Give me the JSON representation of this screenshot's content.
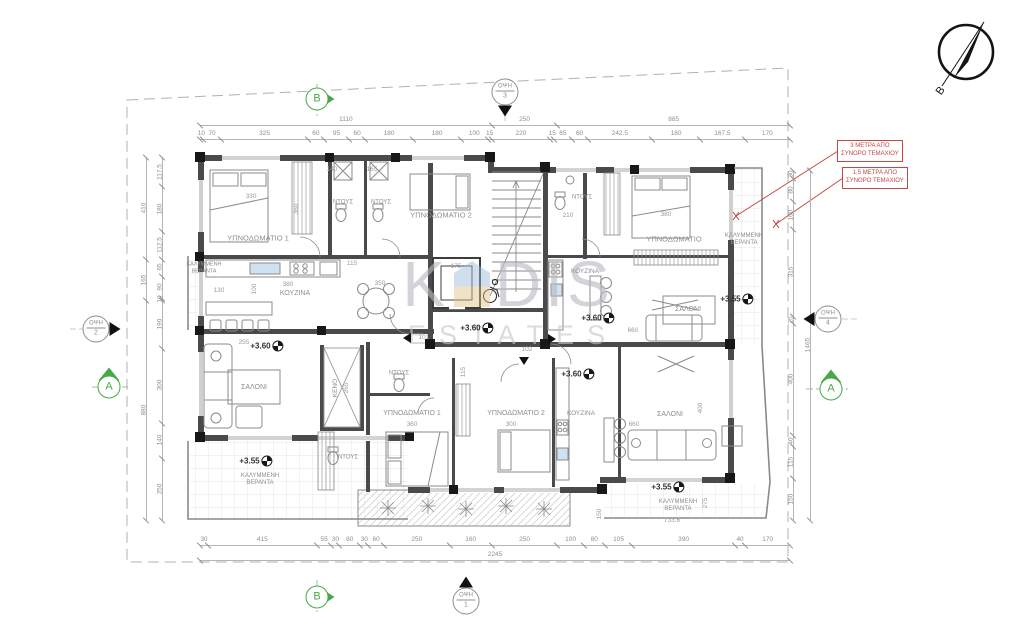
{
  "watermark": {
    "prefix": "K",
    "suffix": "DIS",
    "sub": "ESTATES"
  },
  "compass": {
    "north_letter": "B"
  },
  "red_notes": [
    {
      "line1": "3 ΜΕΤΡΑ ΑΠΟ",
      "line2": "ΣΥΝΟΡΟ ΤΕΜΑΧΙΟΥ",
      "x": 837,
      "y": 140
    },
    {
      "line1": "1,5 ΜΕΤΡΑ ΑΠΟ",
      "line2": "ΣΥΝΟΡΟ ΤΕΜΑΧΙΟΥ",
      "x": 842,
      "y": 167
    }
  ],
  "section_markers": [
    {
      "letter": "B",
      "x": 317,
      "y": 99,
      "dir": "right"
    },
    {
      "letter": "B",
      "x": 317,
      "y": 597,
      "dir": "right"
    },
    {
      "letter": "A",
      "x": 109,
      "y": 387,
      "dir": "up"
    },
    {
      "letter": "A",
      "x": 831,
      "y": 389,
      "dir": "up"
    }
  ],
  "view_markers": [
    {
      "label": "ΟΨΗ",
      "num": "1",
      "x": 466,
      "y": 601,
      "dir": "up"
    },
    {
      "label": "ΟΨΗ",
      "num": "2",
      "x": 96,
      "y": 329,
      "dir": "right"
    },
    {
      "label": "ΟΨΗ",
      "num": "3",
      "x": 505,
      "y": 92,
      "dir": "down"
    },
    {
      "label": "ΟΨΗ",
      "num": "4",
      "x": 828,
      "y": 319,
      "dir": "left"
    }
  ],
  "room_labels": [
    {
      "t": "ΥΠΝΟΔΩΜΑΤΙΟ 1",
      "x": 258,
      "y": 238,
      "s": 7.5
    },
    {
      "t": "ΝΤΟΥΣ",
      "x": 343,
      "y": 203,
      "s": 6
    },
    {
      "t": "ΝΤΟΥΣ",
      "x": 381,
      "y": 203,
      "s": 6
    },
    {
      "t": "ΥΠΝΟΔΩΜΑΤΙΟ 2",
      "x": 441,
      "y": 215,
      "s": 7.5
    },
    {
      "t": "ΚΟΥΖΙΝΑ",
      "x": 295,
      "y": 294,
      "s": 7
    },
    {
      "t": "ΚΑΛΥΜΜΕΝΗ\nΒΕΡΑΝΤΑ",
      "x": 204,
      "y": 268,
      "s": 5.5
    },
    {
      "t": "ΝΤΟΥΣ",
      "x": 582,
      "y": 198,
      "s": 6
    },
    {
      "t": "ΥΠΝΟΔΩΜΑΤΙΟ",
      "x": 674,
      "y": 239,
      "s": 7.5
    },
    {
      "t": "ΚΑΛΥΜΜΕΝΗ\nΒΕΡΑΝΤΑ",
      "x": 744,
      "y": 240,
      "s": 6
    },
    {
      "t": "ΚΟΥΖΙΝΑ",
      "x": 585,
      "y": 272,
      "s": 6.5
    },
    {
      "t": "ΣΑΛΟΝΙ",
      "x": 688,
      "y": 310,
      "s": 7
    },
    {
      "t": "ΣΑΛΟΝΙ",
      "x": 254,
      "y": 388,
      "s": 7
    },
    {
      "t": "ΚΕΝΟ",
      "x": 336,
      "y": 388,
      "s": 6.5,
      "r": 1
    },
    {
      "t": "ΝΤΟΥΣ",
      "x": 399,
      "y": 374,
      "s": 6
    },
    {
      "t": "ΥΠΝΟΔΩΜΑΤΙΟ 1",
      "x": 412,
      "y": 414,
      "s": 7
    },
    {
      "t": "ΝΤΟΥΣ",
      "x": 348,
      "y": 458,
      "s": 6
    },
    {
      "t": "ΚΑΛΥΜΜΕΝΗ\nΒΕΡΑΝΤΑ",
      "x": 260,
      "y": 480,
      "s": 6
    },
    {
      "t": "ΥΠΝΟΔΩΜΑΤΙΟ 2",
      "x": 516,
      "y": 414,
      "s": 7
    },
    {
      "t": "ΚΟΥΖΙΝΑ",
      "x": 581,
      "y": 414,
      "s": 6.5
    },
    {
      "t": "ΣΑΛΟΝΙ",
      "x": 670,
      "y": 415,
      "s": 7
    },
    {
      "t": "ΚΑΛΥΜΜΕΝΗ\nΒΕΡΑΝΤΑ",
      "x": 678,
      "y": 506,
      "s": 6
    }
  ],
  "dim_labels": [
    {
      "t": "330",
      "x": 251,
      "y": 197
    },
    {
      "t": "140",
      "x": 332,
      "y": 170
    },
    {
      "t": "165",
      "x": 372,
      "y": 170
    },
    {
      "t": "360",
      "x": 297,
      "y": 209,
      "r": 1
    },
    {
      "t": "380",
      "x": 666,
      "y": 215
    },
    {
      "t": "350",
      "x": 380,
      "y": 284
    },
    {
      "t": "380",
      "x": 288,
      "y": 285
    },
    {
      "t": "130",
      "x": 219,
      "y": 291
    },
    {
      "t": "100",
      "x": 255,
      "y": 289,
      "r": 1
    },
    {
      "t": "115",
      "x": 352,
      "y": 264
    },
    {
      "t": "175",
      "x": 456,
      "y": 267
    },
    {
      "t": "210",
      "x": 568,
      "y": 216
    },
    {
      "t": "660",
      "x": 633,
      "y": 331
    },
    {
      "t": "360",
      "x": 412,
      "y": 425
    },
    {
      "t": "300",
      "x": 511,
      "y": 425
    },
    {
      "t": "660",
      "x": 634,
      "y": 425
    },
    {
      "t": "400",
      "x": 701,
      "y": 408,
      "r": 1
    },
    {
      "t": "733.6",
      "x": 672,
      "y": 521
    },
    {
      "t": "275",
      "x": 706,
      "y": 503,
      "r": 1
    },
    {
      "t": "150",
      "x": 600,
      "y": 514,
      "r": 1
    },
    {
      "t": "265",
      "x": 347,
      "y": 388,
      "r": 1
    },
    {
      "t": "115",
      "x": 464,
      "y": 372,
      "r": 1
    },
    {
      "t": "101",
      "x": 424,
      "y": 338
    },
    {
      "t": "102",
      "x": 527,
      "y": 350
    },
    {
      "t": "255",
      "x": 244,
      "y": 343
    }
  ],
  "elevation_labels": [
    {
      "t": "+3.60",
      "x": 267,
      "y": 346
    },
    {
      "t": "+3.60",
      "x": 477,
      "y": 328
    },
    {
      "t": "+3.60",
      "x": 598,
      "y": 318
    },
    {
      "t": "+3.60",
      "x": 578,
      "y": 374
    },
    {
      "t": "+3.55",
      "x": 737,
      "y": 299
    },
    {
      "t": "+3.55",
      "x": 256,
      "y": 461
    },
    {
      "t": "+3.55",
      "x": 668,
      "y": 487
    }
  ],
  "entry_arrows": [
    {
      "x": 407,
      "y": 338,
      "dir": "left"
    },
    {
      "x": 552,
      "y": 339,
      "dir": "right"
    },
    {
      "x": 524,
      "y": 361,
      "dir": "down"
    }
  ],
  "dim_lines": {
    "top_outer": {
      "dir": "h",
      "x": 200,
      "y": 125,
      "len": 590,
      "values": [
        "1110",
        "250",
        "885"
      ]
    },
    "top_inner": {
      "dir": "h",
      "x": 200,
      "y": 139,
      "len": 590,
      "values": [
        "10",
        "70",
        "325",
        "60",
        "95",
        "60",
        "180",
        "180",
        "100",
        "15",
        "220",
        "15",
        "65",
        "60",
        "242.5",
        "180",
        "167.5",
        "170"
      ]
    },
    "bottom": {
      "dir": "h",
      "x": 200,
      "y": 545,
      "len": 590,
      "values": [
        "30",
        "415",
        "55",
        "30",
        "80",
        "30",
        "60",
        "250",
        "160",
        "250",
        "100",
        "80",
        "105",
        "390",
        "40",
        "170"
      ]
    },
    "bottom_total": {
      "dir": "h",
      "x": 200,
      "y": 560,
      "len": 590,
      "values": [
        "2245"
      ]
    },
    "left_outer": {
      "dir": "v",
      "x": 146,
      "y": 157,
      "len": 363,
      "values": [
        "410",
        "165",
        "880"
      ]
    },
    "left_inner": {
      "dir": "v",
      "x": 162,
      "y": 157,
      "len": 363,
      "values": [
        "117.5",
        "180",
        "112.5",
        "65",
        "90",
        "10",
        "190",
        "300",
        "140",
        "250"
      ]
    },
    "right_inner": {
      "dir": "v",
      "x": 793,
      "y": 170,
      "len": 350,
      "values": [
        "30",
        "80",
        "100",
        "315",
        "25",
        "400",
        "40",
        "115",
        "150"
      ]
    },
    "right_outer": {
      "dir": "v",
      "x": 810,
      "y": 170,
      "len": 350,
      "values": [
        "1465"
      ]
    }
  }
}
